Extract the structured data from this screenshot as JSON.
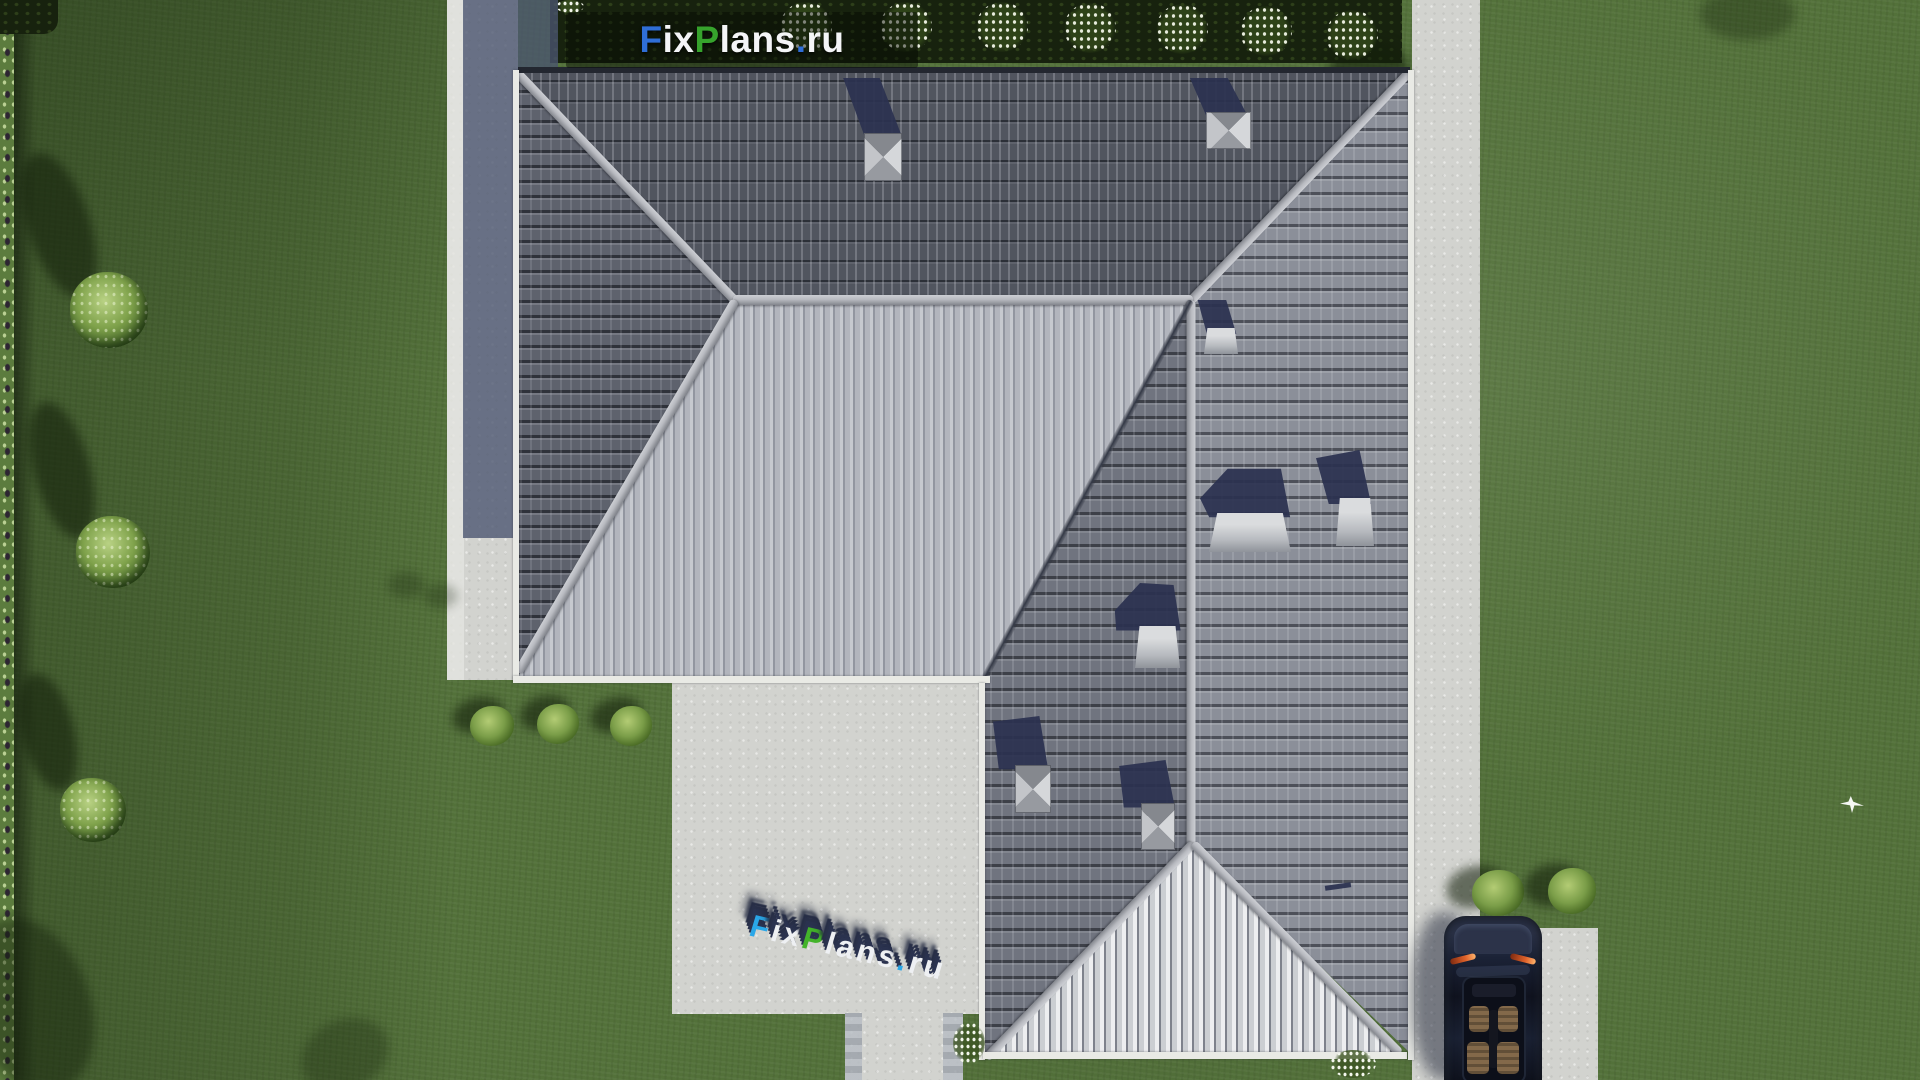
{
  "scene": {
    "description": "Top-down 3D architectural render of a hip-roof house with lawn, hedges, concrete walkways, patio, driveway and a parked car",
    "palette": {
      "grass": "#53713a",
      "grass_dark": "#3f5a26",
      "hedge": "#17220e",
      "concrete": "#d2d3cf",
      "concrete_shadow": "#5f6880",
      "roof_north": "#51555f",
      "roof_south": "#a6aab3",
      "roof_east": "#8b8f99",
      "roof_west_wing": "#70747f",
      "roof_hip_bright": "#bcbfc4",
      "ridge": "#b8bac0",
      "shadow_navy": "#2b3150",
      "car_body": "#141a2b",
      "logo_blue": "#2f6ed6",
      "logo_green": "#36a32c",
      "logo_white": "#f4f5f7",
      "wm_blue": "#2aa7e8",
      "wm_green": "#43b32a",
      "wm_white": "#eef0f3"
    },
    "objects": {
      "house_roof": "hipped tile roof, L-shaped",
      "chimneys": 4,
      "roof_hatches": 4,
      "hedge_flower_bushes": 7,
      "lawn_trees": 3,
      "lawn_bushes": 3,
      "driveway_bushes": 2,
      "car": "dark navy car parked on driveway, top view",
      "bird": "white bird flying over right lawn"
    }
  },
  "logo": {
    "text": "FixPlans.ru",
    "segments": [
      {
        "text": "F",
        "color": "#2f6ed6"
      },
      {
        "text": "ix",
        "color": "#f4f5f7"
      },
      {
        "text": "P",
        "color": "#36a32c"
      },
      {
        "text": "lans",
        "color": "#f4f5f7"
      },
      {
        "text": ".",
        "color": "#2f6ed6"
      },
      {
        "text": "ru",
        "color": "#f4f5f7"
      }
    ]
  },
  "watermark": {
    "text": "FixPlans.ru",
    "segments": [
      {
        "text": "F",
        "color": "#2aa7e8"
      },
      {
        "text": "ix",
        "color": "#eef0f3"
      },
      {
        "text": "P",
        "color": "#43b32a"
      },
      {
        "text": "lans",
        "color": "#eef0f3"
      },
      {
        "text": ".",
        "color": "#2aa7e8"
      },
      {
        "text": "ru",
        "color": "#eef0f3"
      }
    ]
  }
}
